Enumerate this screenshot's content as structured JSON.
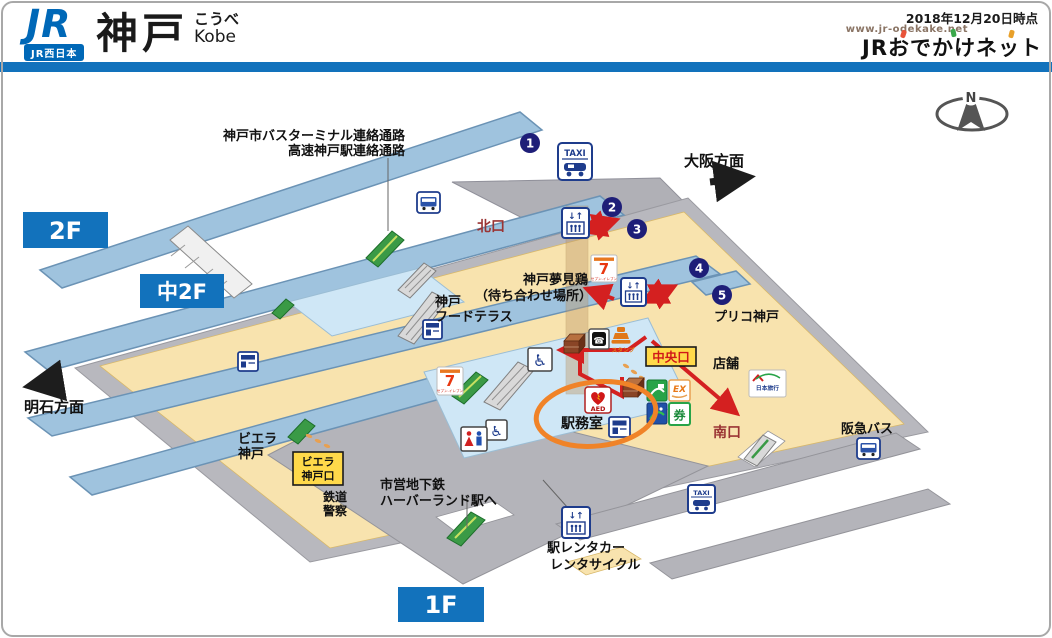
{
  "header": {
    "logo_jr": "JR",
    "logo_company": "JR西日本",
    "station_kanji": "神戸",
    "station_kana": "こうべ",
    "station_romaji": "Kobe",
    "date_note": "2018年12月20日時点",
    "site_url": "www.jr-odekake.net",
    "site_name": "JRおでかけネット"
  },
  "colors": {
    "header_blue": "#1272bc",
    "platform_blue": "#9fc3de",
    "concourse_beige": "#f8e3ae",
    "concourse_lightblue": "#cfe7f6",
    "floor_gray": "#b6b6bc",
    "route_red": "#d42020",
    "highlight_orange": "#f08328",
    "gate_text_red": "#9a3434"
  },
  "map": {
    "floors": {
      "f2": "2F",
      "m2f": "中2F",
      "f1": "1F"
    },
    "directions": {
      "osaka": "大阪方面",
      "akashi": "明石方面",
      "compass": "N"
    },
    "corridor": {
      "line1": "神戸市バスターミナル連絡通路",
      "line2": "高速神戸駅連絡通路"
    },
    "gates": {
      "north": "北口",
      "central": "中央口",
      "south": "南口",
      "viera_line1": "ビエラ",
      "viera_line2": "神戸口"
    },
    "places": {
      "meeting_line1": "神戸夢見鶏",
      "meeting_line2": "（待ち合わせ場所）",
      "food_line1": "神戸",
      "food_line2": "フードテラス",
      "puriko": "プリコ神戸",
      "tenpo": "店舗",
      "hankyu_bus": "阪急バス",
      "viera_line1": "ビエラ",
      "viera_line2": "神戸",
      "police_line1": "鉄道",
      "police_line2": "警察",
      "subway_line1": "市営地下鉄",
      "subway_line2": "ハーバーランド駅へ",
      "rental_line1": "駅レンタカー",
      "rental_line2": "レンタサイクル",
      "office": "駅務室",
      "nippon_travel": "日本旅行"
    },
    "platforms": {
      "p1": "1",
      "p2": "2",
      "p3": "3",
      "p4": "4",
      "p5": "5"
    },
    "icon_labels": {
      "taxi": "TAXI",
      "aed": "AED",
      "ex": "EX",
      "ticket": "券",
      "seven": "7",
      "seven_sub": "セブン-イレブン",
      "stamp": "スタンプ",
      "elevator_arrows": "↓↑",
      "phone": "☎",
      "wheelchair": "♿"
    }
  }
}
